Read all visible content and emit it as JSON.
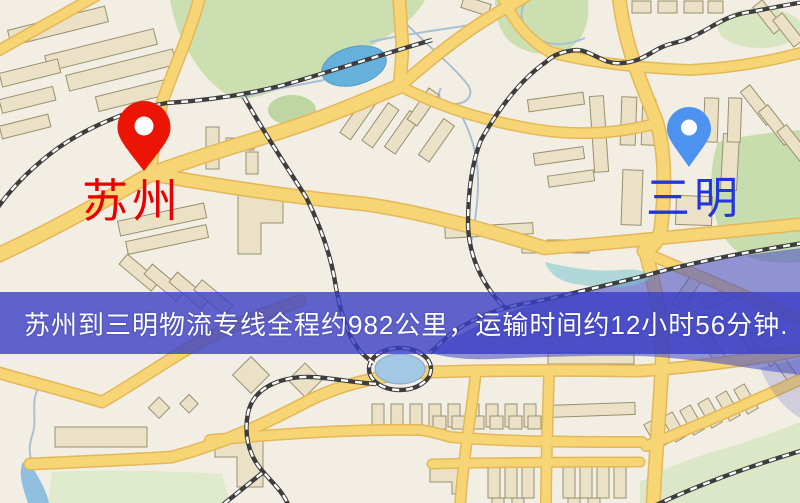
{
  "window": {
    "width": 800,
    "height": 503
  },
  "map": {
    "type": "road-map",
    "origin_marker": {
      "label": "苏州",
      "pin_color": "#ec1404",
      "label_color": "#e60000",
      "pin_style": "red-teardrop-pin"
    },
    "destination_marker": {
      "label": "三明",
      "pin_color": "#4b93ef",
      "label_color": "#2335dd",
      "pin_style": "blue-teardrop-pin"
    },
    "palette": {
      "background": "#f3eee4",
      "road": "#f7d474",
      "road_casing": "#e3b85a",
      "building": "#eae1c6",
      "building_outline": "#99906f",
      "park_green": "#cbdfb0",
      "pond_blue": "#66b1dc",
      "lake_overlay": "rgba(72,80,196,0.58)",
      "railway": "#3d3d3d"
    }
  },
  "banner": {
    "text": "苏州到三明物流专线全程约982公里，运输时间约12小时56分钟.",
    "background": "rgba(58,62,196,0.8)",
    "text_color": "#ffffff",
    "route": {
      "origin": "苏州",
      "destination": "三明",
      "service": "物流专线",
      "distance": "约982公里",
      "duration": "约12小时56分钟"
    }
  }
}
